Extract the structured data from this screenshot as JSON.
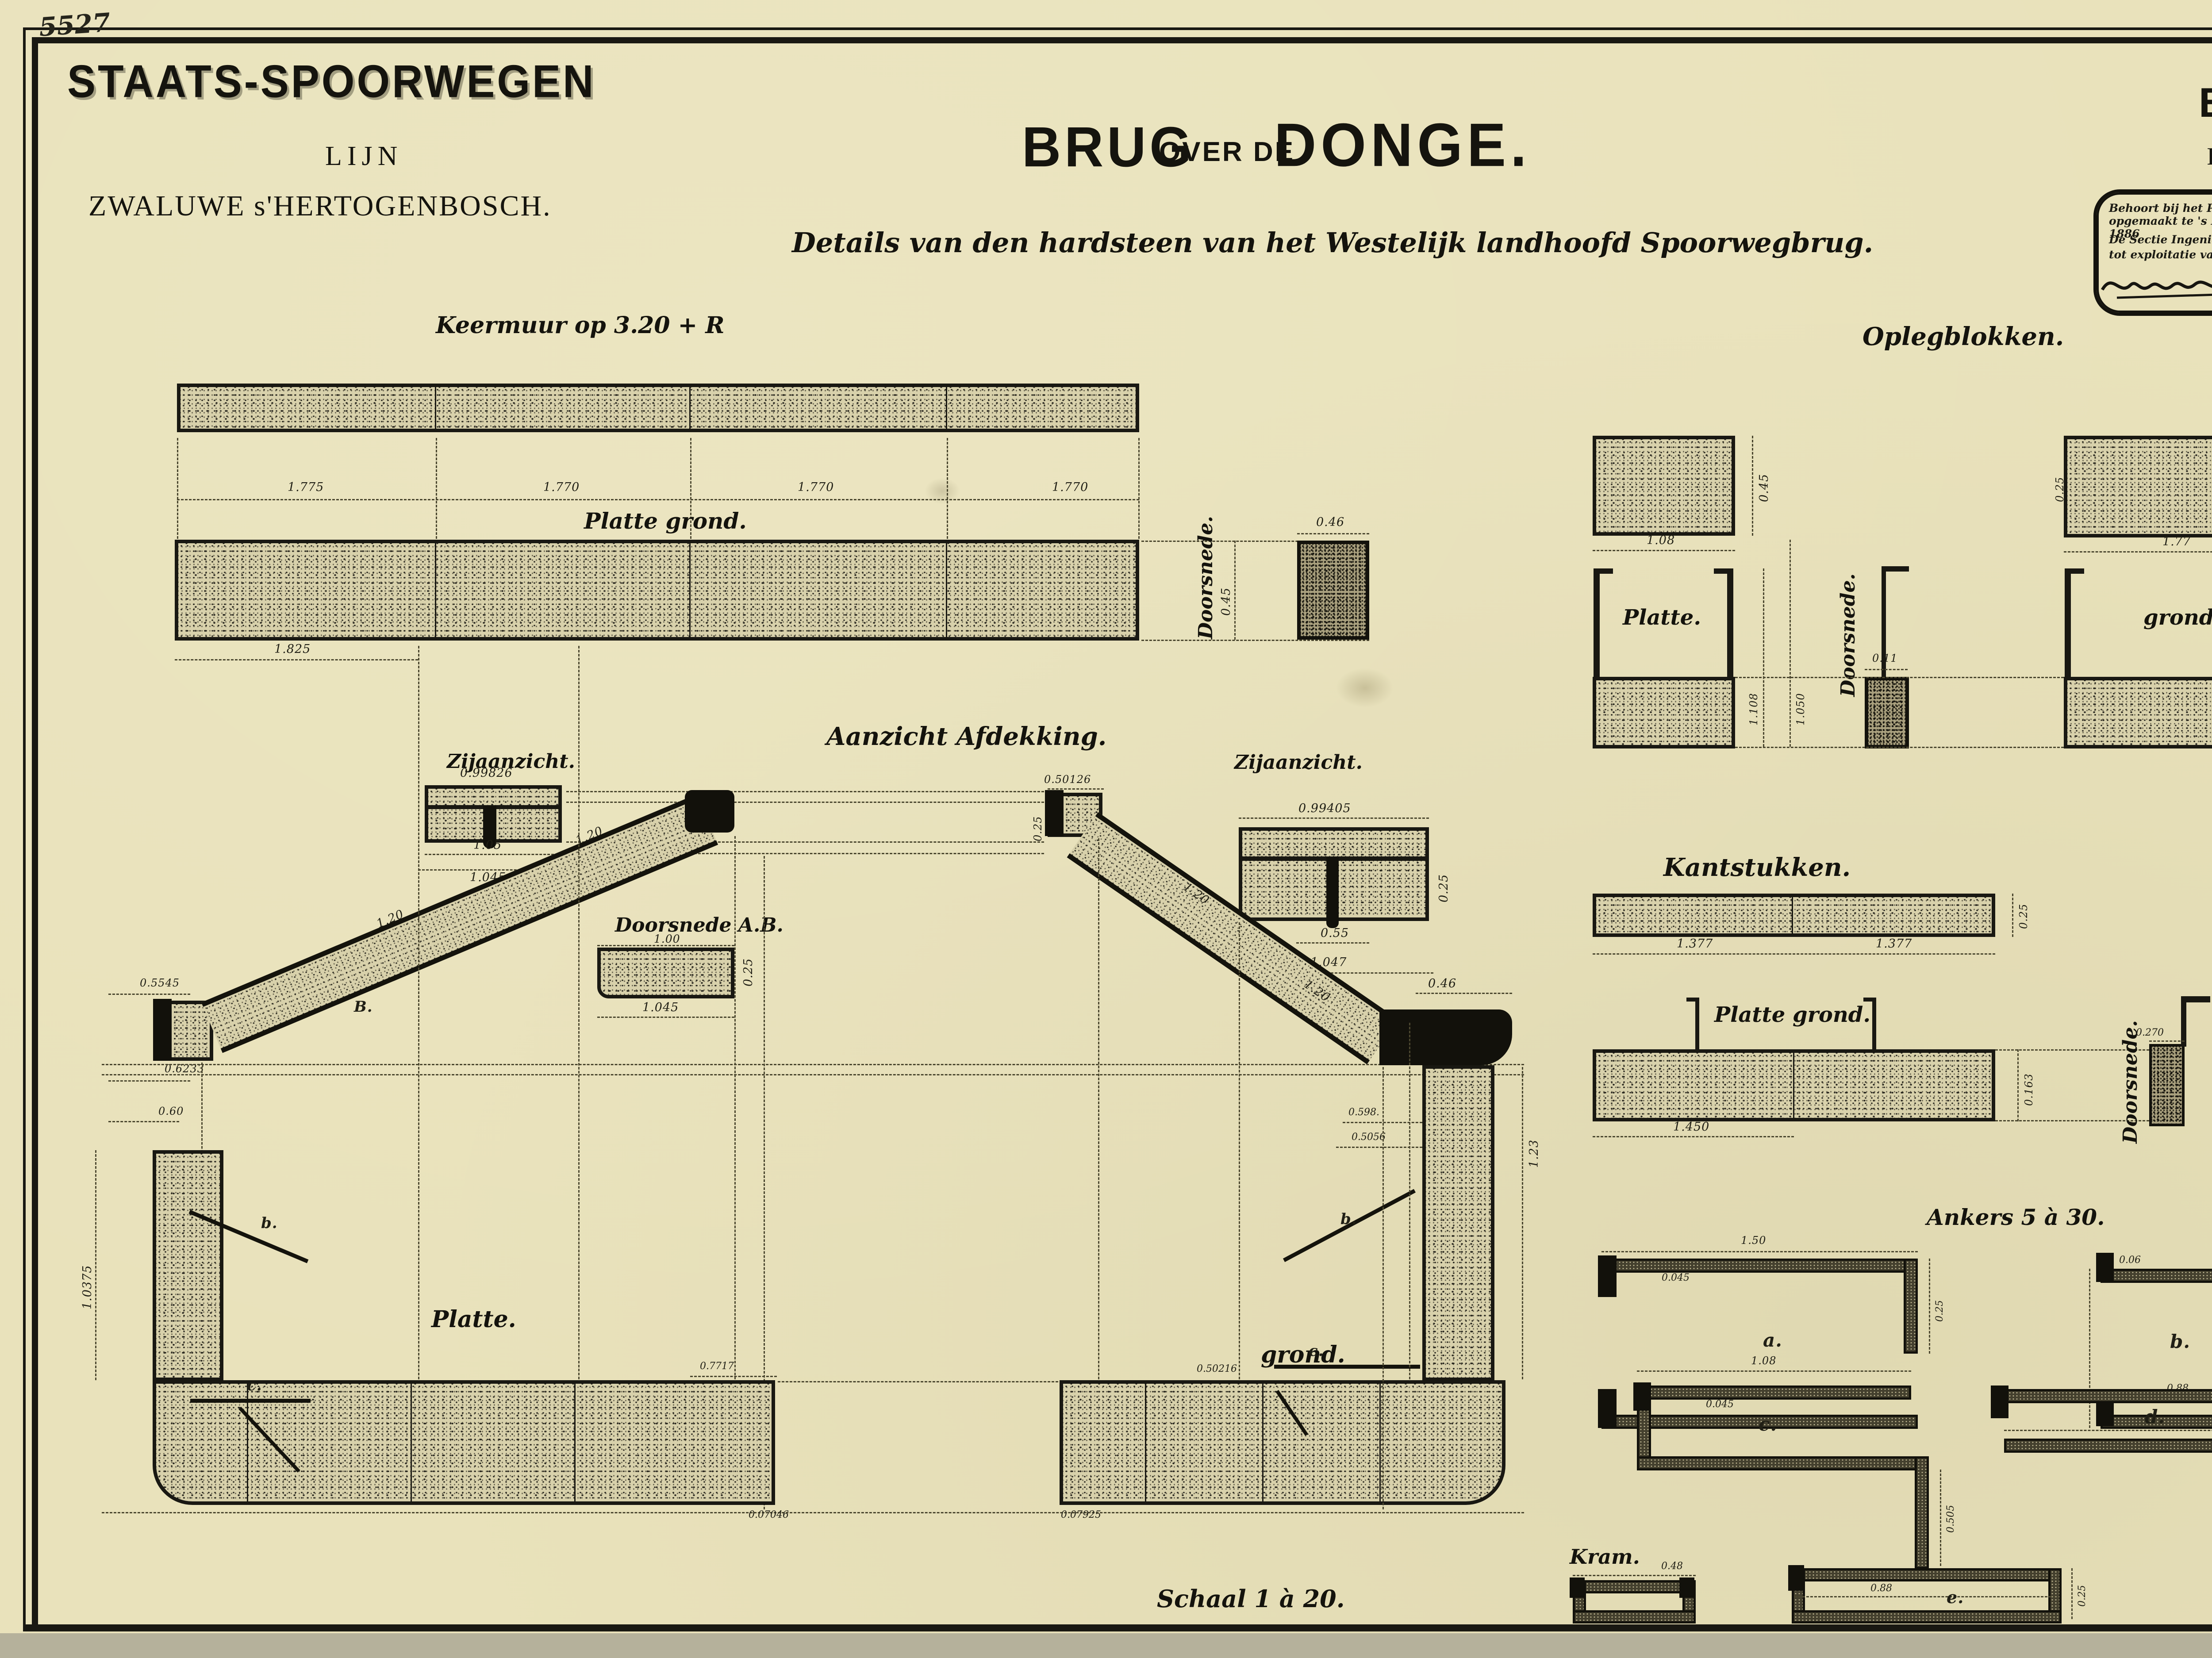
{
  "sheet": {
    "registration_number": "5527"
  },
  "header_left": {
    "company": "STAATS-SPOORWEGEN",
    "line_word": "LIJN",
    "line_route": "ZWALUWE s'HERTOGENBOSCH."
  },
  "title": {
    "part1": "BRUG",
    "part2": "OVER DE",
    "part3": "DONGE.",
    "subtitle": "Details van den hardsteen van het Westelijk landhoofd Spoorwegbrug."
  },
  "header_right": {
    "bestek_n": "BESTEK N",
    "bestek_sup": "o",
    "bestek_num": "861.",
    "si_pre": "In 25 bladen 11",
    "si_sup": "e",
    "si_post": "blad."
  },
  "stamp": {
    "line1": "Behoort bij het Proces-verbaal in drievoud opgemaakt te 's Hertogenbosch den 30 October 1886",
    "left_title1": "De Sectie Ingenieur bij de Maatschappij",
    "left_title2": "tot exploitatie van Staatsspoorwegen.",
    "right_title1": "De eerstaanwezend Ingenieur",
    "right_title2": "bij de Staatsspoorwegen."
  },
  "keermuur": {
    "title": "Keermuur op 3.20 + R",
    "plan_label": "Platte grond.",
    "section_label": "Doorsnede.",
    "dims": {
      "a": "1.775",
      "b": "1.770",
      "c": "1.770",
      "d": "1.770",
      "e": "1.825",
      "sq": "0.46",
      "v": "0.45"
    }
  },
  "afdekking": {
    "title": "Aanzicht Afdekking.",
    "left_side_label": "Zijaanzicht.",
    "right_side_label": "Zijaanzicht.",
    "section_ab_label": "Doorsnede A.B.",
    "plan_left_label": "Platte.",
    "plan_right_label": "grond.",
    "marks": {
      "A": "A.",
      "B": "B.",
      "b1": "b.",
      "c1": "c.",
      "b2": "b.",
      "c2": "c."
    },
    "dims": {
      "zl_top": "0.99826",
      "zl_b1": "1.05",
      "zl_b2": "1.045",
      "ab_top": "1.00",
      "ab_bot": "1.045",
      "ab_side": "0.25",
      "stub1": "0.5545",
      "stub2": "0.6233",
      "stub3": "0.60",
      "sl1": "1.20",
      "sl2": "1.20",
      "sl3": "1.20",
      "sl4": "1.20",
      "rstub": "0.50126",
      "rstub2": "0.306",
      "rstub3": "0.25",
      "zr_top": "0.99405",
      "zr_mid": "0.55",
      "zr_bot": "1.047",
      "zr_side": "0.25",
      "elb": "0.46",
      "r1": "0.598.",
      "r2": "0.5056",
      "rv": "1.23",
      "lv": "1.0375",
      "lpr": "0.7717",
      "lb": "0.07046",
      "rb": "0.07925",
      "rp": "0.50216"
    }
  },
  "oplegblokken": {
    "title": "Oplegblokken.",
    "plan_left": "Platte.",
    "plan_right": "grond.",
    "section": "Doorsnede.",
    "dims": {
      "d1": "1.08",
      "d2": "1.77",
      "d3": "0.11",
      "d4": "1.108",
      "d5": "1.050",
      "d6": "0.45",
      "d7": "0.45",
      "d8": "0.25"
    }
  },
  "kantstukken": {
    "title": "Kantstukken.",
    "plan_label": "Platte grond.",
    "section": "Doorsnede.",
    "dims": {
      "d1": "1.377",
      "d2": "1.377",
      "d3": "1.450",
      "d4": "0.270",
      "d5": "0.25",
      "d6": "0.163"
    }
  },
  "ankers": {
    "title": "Ankers 5 à 30.",
    "labels": {
      "a": "a.",
      "b": "b.",
      "c": "c.",
      "d": "d.",
      "e": "e."
    },
    "kram": "Kram.",
    "dims": {
      "a_top": "1.50",
      "a_t": "0.045",
      "a_s": "0.25",
      "b_t": "0.06",
      "b_in": "0.88",
      "c_top": "1.08",
      "c_t": "0.045",
      "c_s": "0.505",
      "d_mid": "1.72",
      "d_s": "0.50",
      "e_mid": "0.88",
      "e_s": "0.25",
      "k_top": "0.48"
    }
  },
  "schaal": "Schaal 1 à 20."
}
